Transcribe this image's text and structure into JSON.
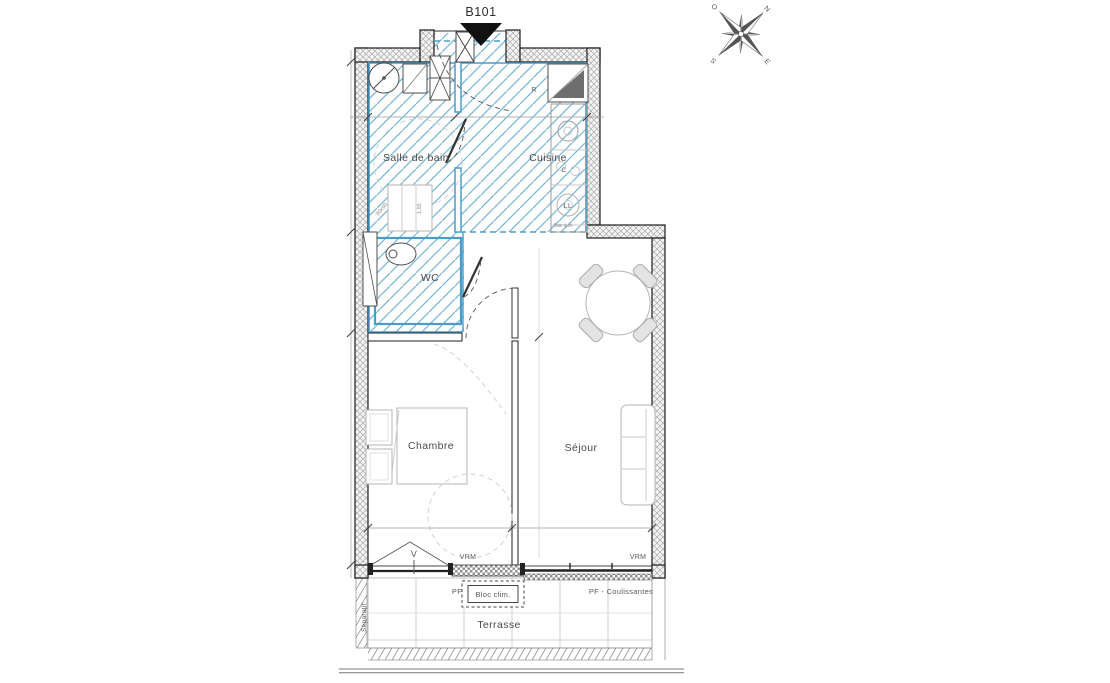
{
  "plan": {
    "unit_number": "B101",
    "rooms": {
      "bathroom": "Salle de bain",
      "kitchen": "Cuisine",
      "wc": "WC",
      "bedroom": "Chambre",
      "living_room": "Séjour",
      "terrace": "Terrasse"
    },
    "appliances": {
      "fridge": "R",
      "cooktop": "C",
      "washing_machine": "LL",
      "sorting_bin": "Bac à tri"
    },
    "openings": {
      "window_label": "V",
      "roller_blind_left": "VRM",
      "roller_blind_right": "VRM",
      "french_window": "PF",
      "sliding_french_window": "PF - Coulissantes",
      "ac_unit": "Bloc clim."
    },
    "terrace_notes": {
      "separator": "Séparatif"
    },
    "dimensions": {
      "shower": "90x90",
      "clearance": "1,55"
    },
    "compass": {
      "north": "N",
      "south": "S",
      "east": "E",
      "west": "O"
    }
  },
  "colors": {
    "wet_area_hatch": "#74b4d9",
    "wall_outline": "#1c1c1c",
    "furniture_stroke": "#b5b5b5",
    "label_text": "#4a4a4a"
  }
}
